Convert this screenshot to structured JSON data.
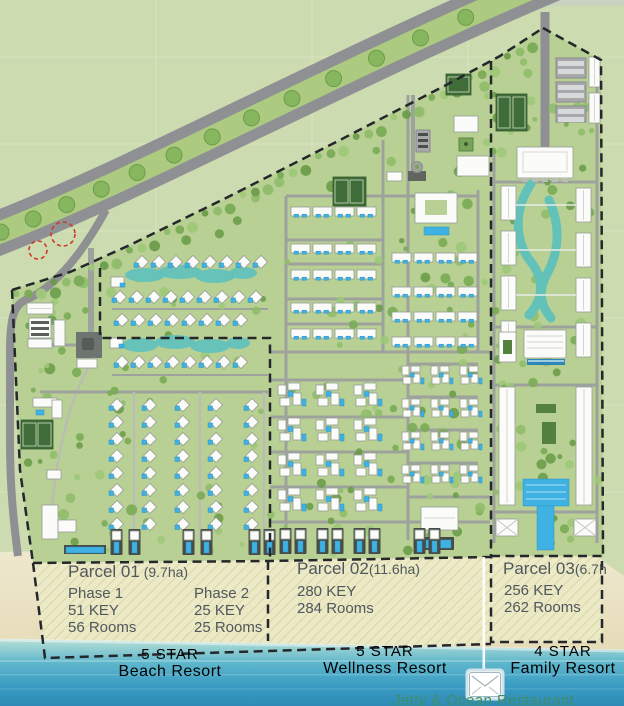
{
  "map": {
    "parcels": [
      {
        "id": "parcel-01",
        "name": "Parcel 01",
        "area": " (9.7ha)",
        "phases": [
          {
            "label": "Phase 1",
            "keys": "51 KEY",
            "rooms": "56 Rooms"
          },
          {
            "label": "Phase 2",
            "keys": "25 KEY",
            "rooms": "25 Rooms"
          }
        ],
        "stars": "5 STAR",
        "resort": "Beach Resort"
      },
      {
        "id": "parcel-02",
        "name": "Parcel 02",
        "area": "(11.6ha)",
        "keys": "280 KEY",
        "rooms": "284 Rooms",
        "stars": "5 STAR",
        "resort": "Wellness Resort"
      },
      {
        "id": "parcel-03",
        "name": "Parcel 03",
        "area": "(6.7h",
        "keys": "256 KEY",
        "rooms": "262 Rooms",
        "stars": "4 STAR",
        "resort": "Family Resort"
      }
    ],
    "waterfront": {
      "label": "Jetty & Ocean Restaurant",
      "icon": "jetty-restaurant-icon"
    },
    "colors": {
      "land": "#cddcb0",
      "site": "#b9d094",
      "road": "#8f9094",
      "median": "#accb80",
      "water": "#62c2ba",
      "pool": "#3fb2e3",
      "sand": "#ece3c6",
      "ocean": "#3da0c4",
      "boundary": "#24272b",
      "hatch": "#ecebc8",
      "text": "#4f585c",
      "jetty_text": "#3f8e68",
      "alert": "#cc3a28"
    }
  }
}
